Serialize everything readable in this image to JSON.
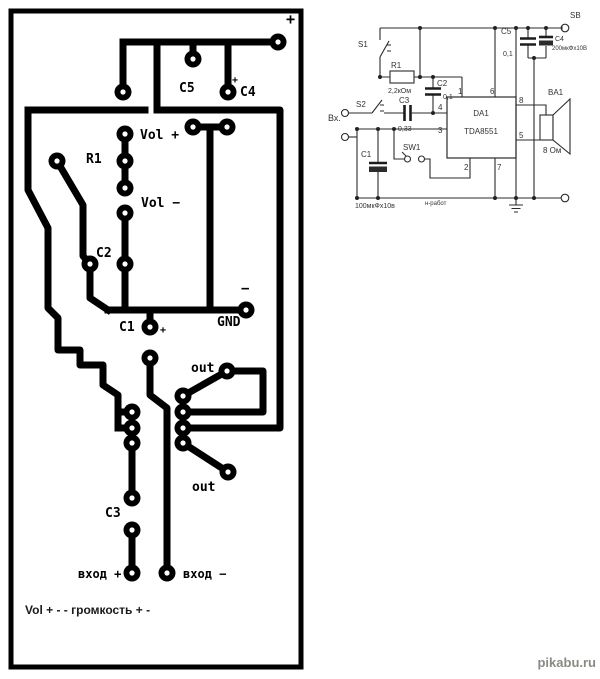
{
  "pcb": {
    "labels": {
      "plus_top": "+",
      "c5": "C5",
      "c4_plus": "+",
      "c4": "C4",
      "vol_plus": "Vol +",
      "r1": "R1",
      "vol_minus": "Vol −",
      "c2": "C2",
      "minus": "−",
      "c1": "C1",
      "c1_plus": "+",
      "gnd": "GND",
      "out_top": "out",
      "out_bottom": "out",
      "c3": "C3",
      "in_plus": "вход +",
      "in_minus": "вход −"
    },
    "caption": "Vol + - - громкость + -"
  },
  "schematic": {
    "labels": {
      "sb": "SB",
      "s1": "S1",
      "s2": "S2",
      "sw1": "SW1",
      "r1": "R1",
      "r1_value": "2,2кОм",
      "c2": "C2",
      "c2_value": "0,1",
      "c3": "C3",
      "c3_value": "0,33",
      "c1": "C1",
      "c1_value": "100мкФх10в",
      "c5": "C5",
      "c5_value": "0,1",
      "c4": "C4",
      "c4_value": "200мкФх10В",
      "da1": "DA1",
      "da1_part": "TDA8551",
      "ba1": "BA1",
      "ba1_value": "8 Ом",
      "input": "Вх.",
      "note": "н-работ"
    },
    "pins": {
      "p1": "1",
      "p2": "2",
      "p3": "3",
      "p4": "4",
      "p5": "5",
      "p6": "6",
      "p7": "7",
      "p8": "8"
    }
  },
  "watermark": "pikabu.ru"
}
